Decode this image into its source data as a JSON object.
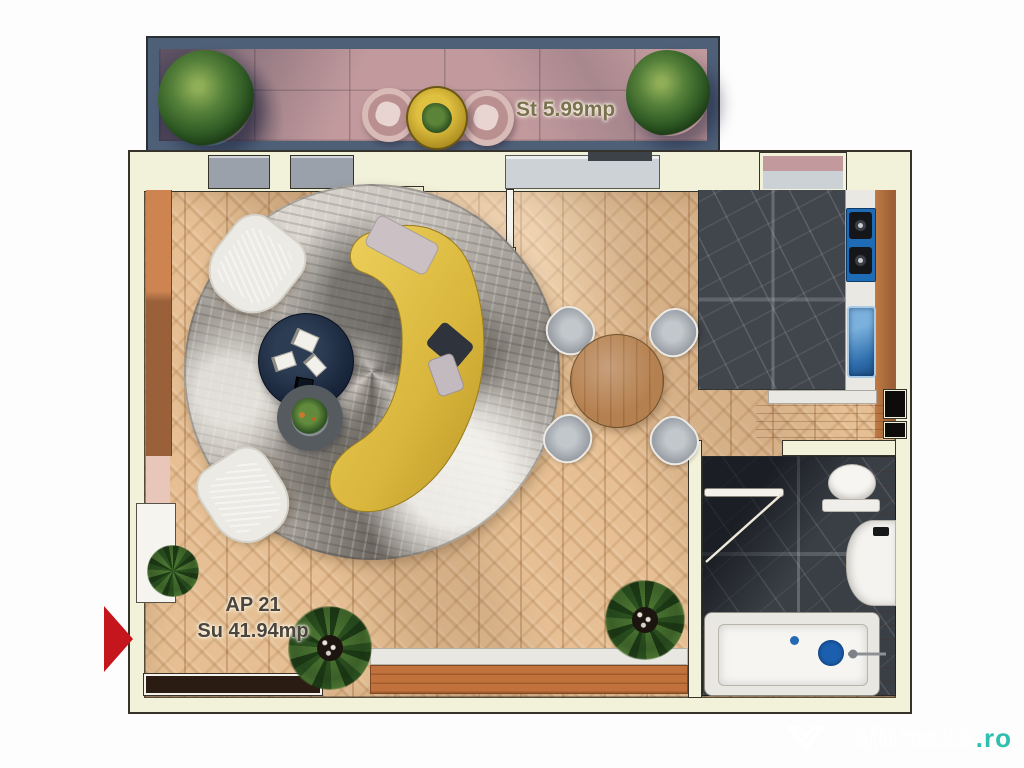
{
  "floor_plan": {
    "terrace_label": "St 5.99mp",
    "apartment_label_line1": "AP 21",
    "apartment_label_line2": "Su 41.94mp"
  },
  "watermark": {
    "brand": "lajumate",
    "tld": ".ro"
  },
  "colors": {
    "entrance_arrow": "#c5161d",
    "watermark_accent": "#2fc0ad",
    "wall_fill": "#f2f2da",
    "wall_outline": "#35332a",
    "terrace_floor": "#c29a9d",
    "terrace_railing": "#4e5f78",
    "wood_floor": "#e6c094",
    "marble_floor": "#41454c",
    "counter_blue": "#1e6cb5",
    "sofa_yellow": "#dcba44",
    "rug_gray": "#b9b4ac",
    "wood_accent": "#c0713c"
  }
}
